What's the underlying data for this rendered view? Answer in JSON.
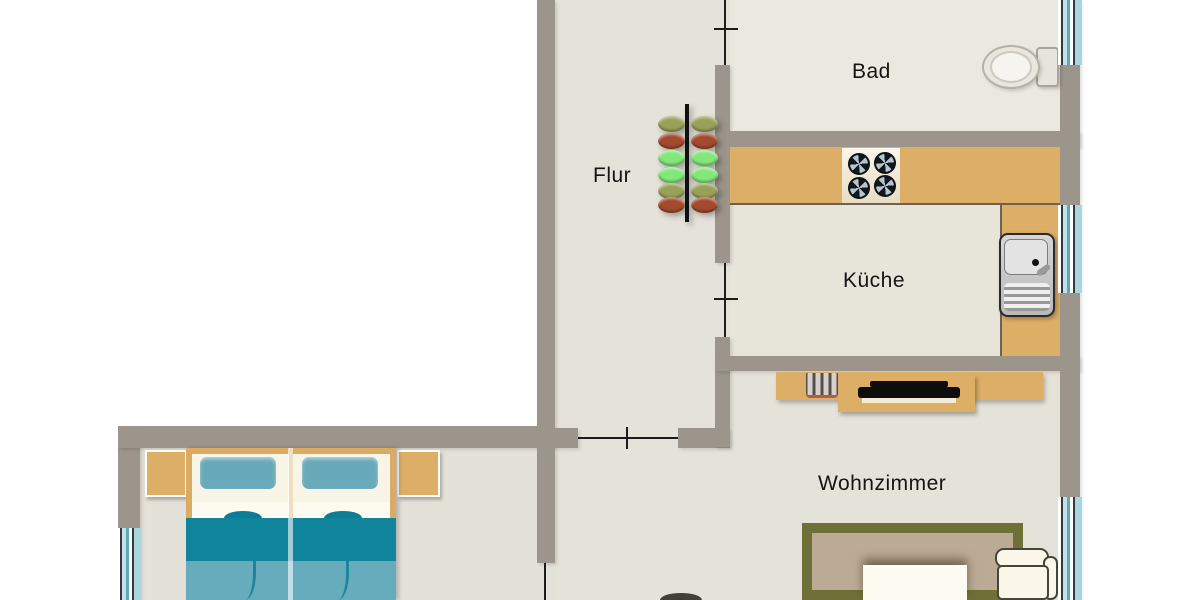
{
  "type": "floor-plan",
  "rooms": [
    {
      "id": "flur",
      "label": "Flur"
    },
    {
      "id": "bad",
      "label": "Bad"
    },
    {
      "id": "kueche",
      "label": "Küche"
    },
    {
      "id": "wohnzimmer",
      "label": "Wohnzimmer"
    }
  ],
  "furniture_icons": [
    "coat-rack-icon",
    "toilet-icon",
    "kitchen-counter",
    "stove-icon",
    "sink-icon",
    "sideboard",
    "radiator-icon",
    "tv-icon",
    "rug",
    "coffee-table",
    "sofa-icon",
    "plant-icon",
    "double-bed-icon",
    "nightstand",
    "window-icon",
    "door-swing-line"
  ],
  "colors": {
    "wall": "#9c958b",
    "floor": "#e5e3d9",
    "floor-bad": "#ebe8df",
    "floor-kueche": "#e7e4da",
    "floor-schlaf": "#e4e1d8",
    "counter": "#ddae66",
    "counter-edge": "#6d6156",
    "rug-border": "#6f7038",
    "rug-inner": "#bcab94",
    "bed-frame": "#dcab63",
    "pillow": "#69aaba",
    "blanket-dark": "#10849b",
    "blanket-light": "#66acbd",
    "hook-olive": "#99a058",
    "hook-red": "#a34a2e",
    "hook-green": "#82e87b",
    "sofa-fill": "#fbf8ea",
    "sofa-outline": "#45453b",
    "door-line": "#1c1c1c",
    "label": "#141414"
  }
}
